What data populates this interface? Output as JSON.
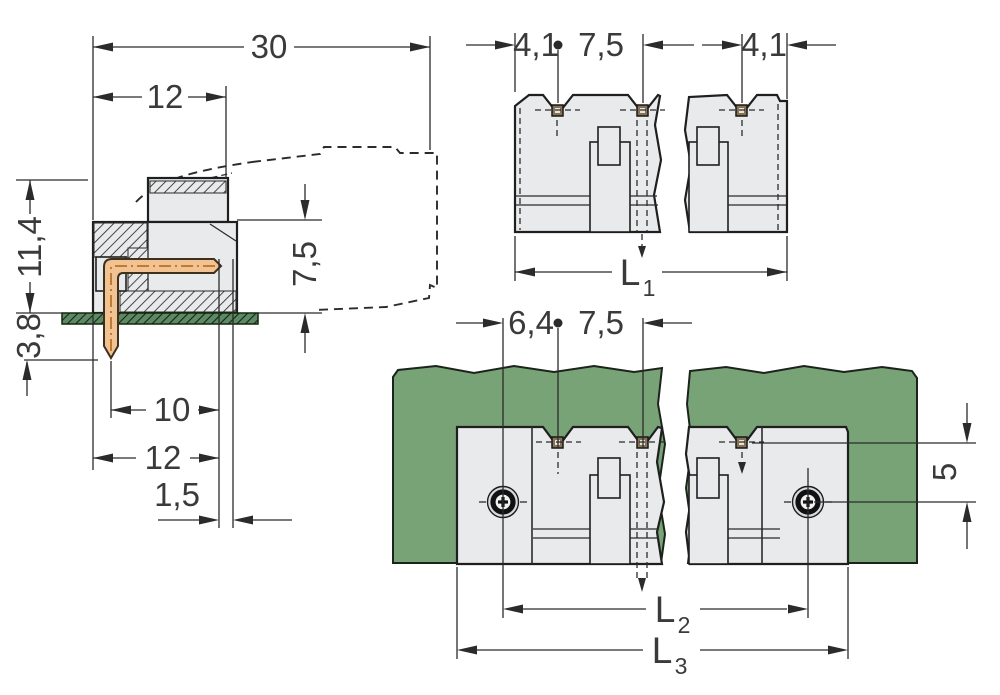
{
  "drawing": {
    "type": "technical-dimension-drawing",
    "description": "THT male header with angled solder pins: side section view, front view and PCB mounting top view",
    "colors": {
      "pcb_green": "#77a377",
      "housing_gray": "#e8eaeb",
      "pin_copper": "#f1c393",
      "line": "#2b2b2b"
    },
    "side_view": {
      "overall_depth": "30",
      "housing_depth": "12",
      "height_above_board": "11,4",
      "pin_length_below_board": "3,8",
      "mating_depth": "7,5",
      "pin_inset": "10",
      "housing_depth_lower": "12",
      "pin_row_offset": "1,5"
    },
    "front_view": {
      "edge_to_first_pin": "4,1",
      "pin_pitch": "7,5",
      "last_pin_to_edge": "4,1",
      "overall_length": {
        "label": "L",
        "sub": "1"
      }
    },
    "board_view": {
      "screw_to_first_pin": "6,4",
      "pin_pitch": "7,5",
      "pin_row_to_screw_row": "5",
      "screw_spacing": {
        "label": "L",
        "sub": "2"
      },
      "overall_length": {
        "label": "L",
        "sub": "3"
      }
    }
  }
}
